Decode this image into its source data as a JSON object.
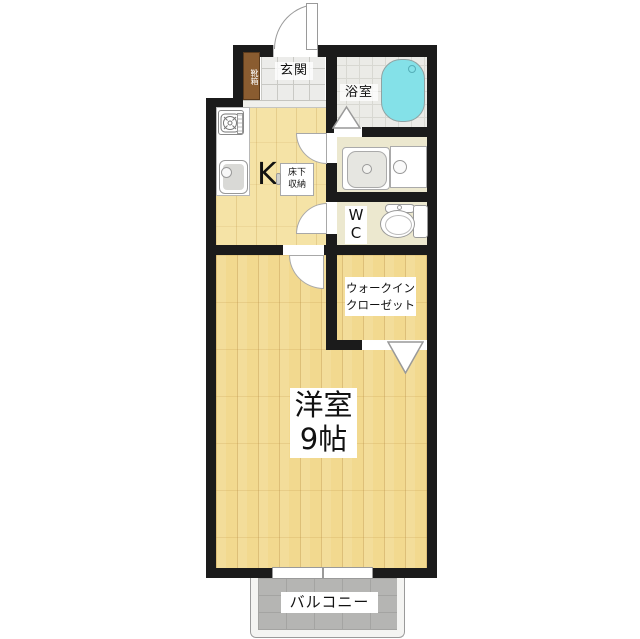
{
  "floorplan": {
    "rooms": {
      "entrance": {
        "label": "玄関"
      },
      "shoe_cabinet": {
        "label": "靴箱"
      },
      "bathroom": {
        "label": "浴室"
      },
      "kitchen": {
        "label": "K"
      },
      "underfloor_storage": {
        "line1": "床下",
        "line2": "収納"
      },
      "toilet": {
        "line1": "W",
        "line2": "C"
      },
      "walk_in_closet": {
        "line1": "ウォークイン",
        "line2": "クローゼット"
      },
      "western_room": {
        "line1": "洋室",
        "line2": "9帖"
      },
      "balcony": {
        "label": "バルコニー"
      }
    },
    "colors": {
      "wall": "#1b1b1b",
      "wood_floor": "#f2d98f",
      "kitchen_floor": "#f5e3a6",
      "cream_room": "#ece8cf",
      "closet_orange": "#ef9a3e",
      "bathtub_cyan": "#84e1e8",
      "balcony_gray": "#b5b5b3",
      "shoe_cabinet_brown": "#8a5c30"
    }
  }
}
